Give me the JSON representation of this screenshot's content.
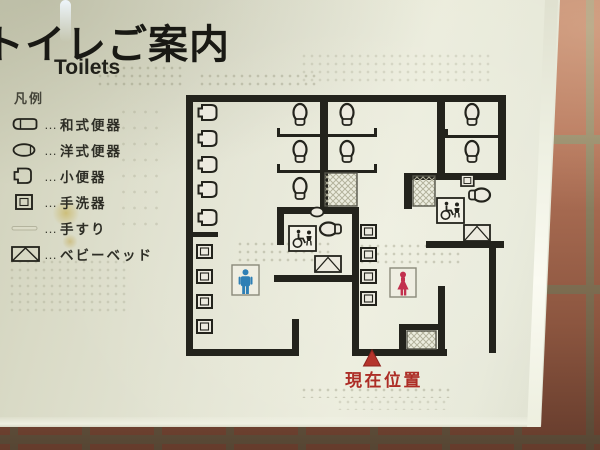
{
  "sign": {
    "title": "トイレご案内",
    "subtitle": "Toilets",
    "legend": {
      "header": "凡例",
      "separator": "…",
      "items": [
        {
          "icon": "squat-toilet-icon",
          "label": "和式便器"
        },
        {
          "icon": "western-toilet-icon",
          "label": "洋式便器"
        },
        {
          "icon": "urinal-icon",
          "label": "小便器"
        },
        {
          "icon": "wash-basin-icon",
          "label": "手洗器"
        },
        {
          "icon": "handrail-icon",
          "label": "手すり"
        },
        {
          "icon": "baby-bed-icon",
          "label": "ベビーベッド"
        }
      ]
    },
    "map": {
      "current_location_label": "現在位置",
      "mens_area": {
        "symbol": "male-figure",
        "urinal_count": 5,
        "wash_basin_count": 4,
        "stall_toilet_count": 3
      },
      "womens_area": {
        "symbol": "female-figure",
        "wash_basin_count": 4,
        "stall_toilet_count": 4
      },
      "accessible_toilet_count": 2
    },
    "colors": {
      "male_symbol": "#2e7fb5",
      "female_symbol": "#c2304e",
      "current_location": "#ad2d26",
      "map_walls": "#23231c",
      "sign_background": "#e3e4d3",
      "tile": "#b5755a",
      "grout": "#948c6b"
    }
  }
}
